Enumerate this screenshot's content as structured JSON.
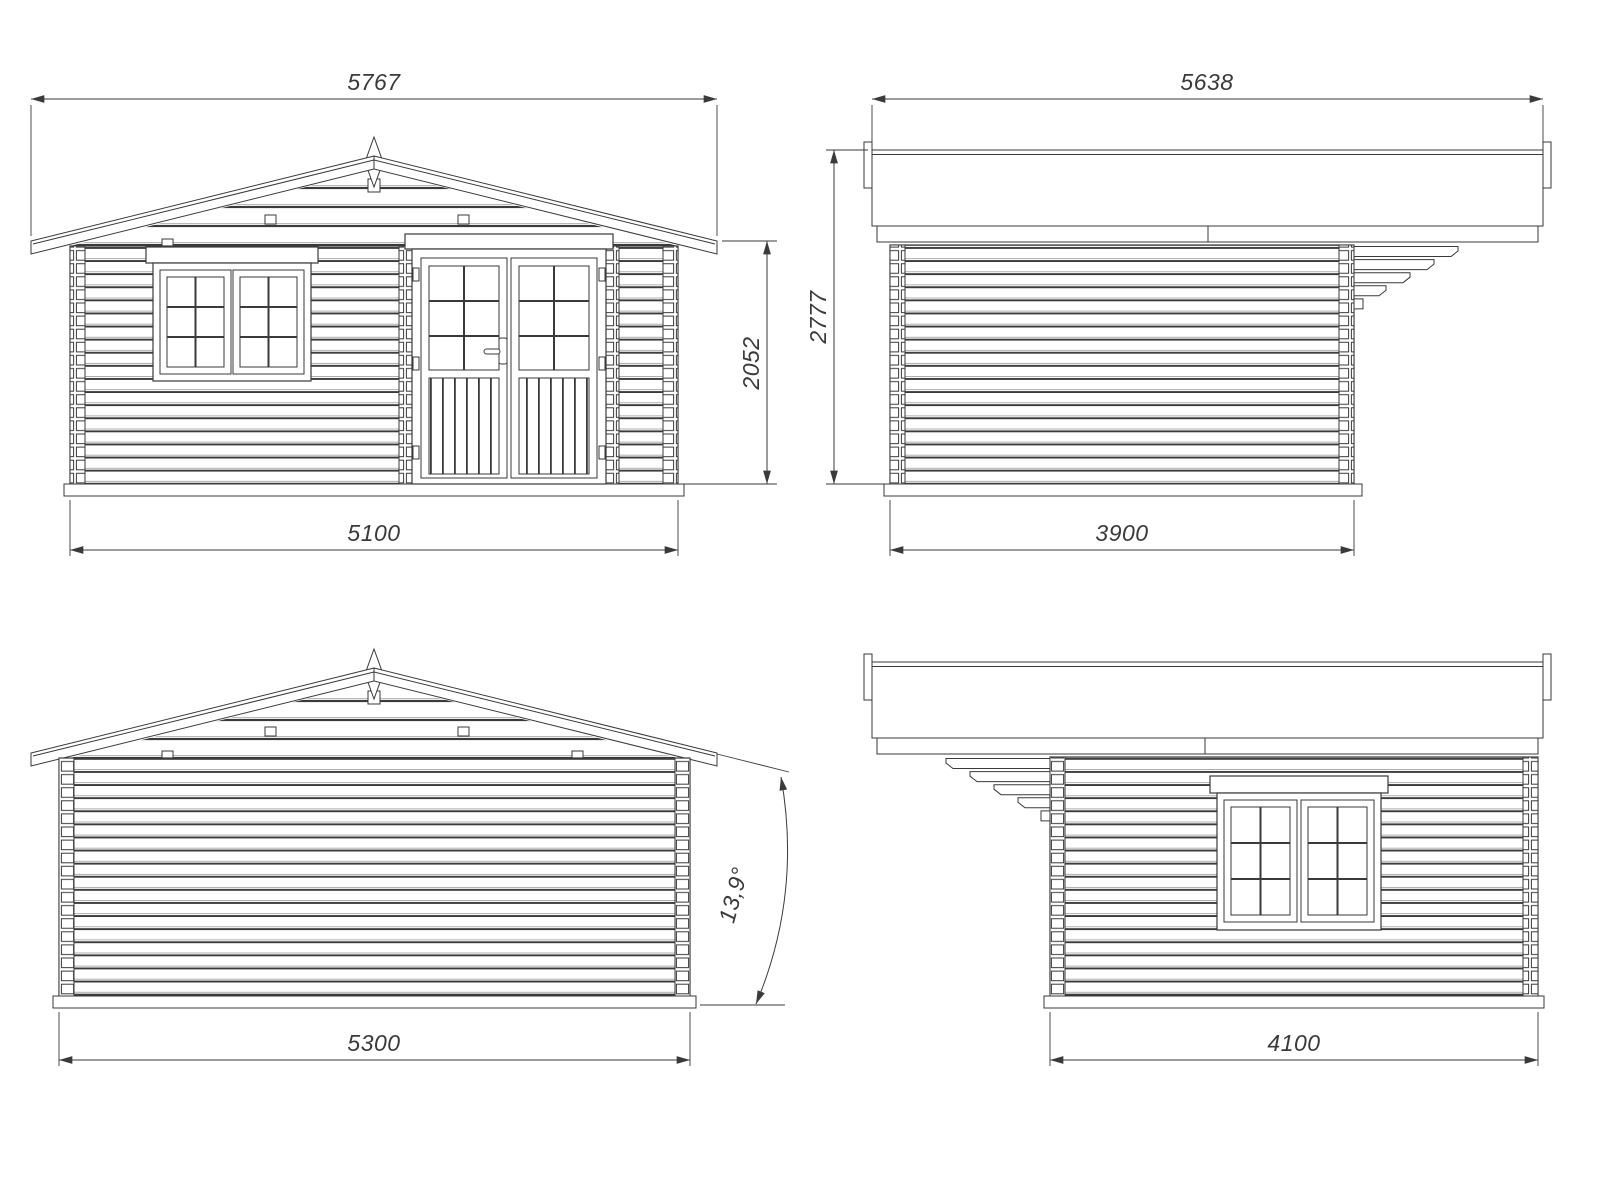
{
  "drawing": {
    "background_color": "#ffffff",
    "line_color": "#3a3a3a",
    "views": {
      "front": {
        "roof_width": "5767",
        "wall_height": "2052",
        "wall_width": "5100"
      },
      "left_side": {
        "roof_length": "5638",
        "total_height": "2777",
        "wall_depth": "3900"
      },
      "rear": {
        "wall_width": "5300",
        "roof_pitch_angle": "13,9°"
      },
      "right_side": {
        "wall_depth": "4100"
      }
    }
  }
}
